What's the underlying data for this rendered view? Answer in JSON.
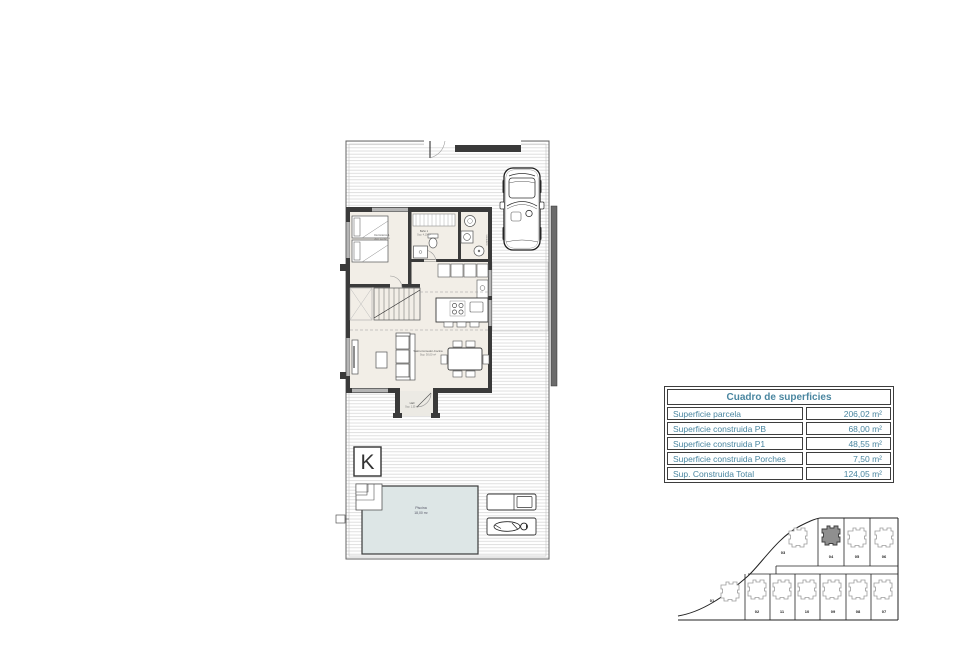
{
  "surfaces_table": {
    "header": "Cuadro de superficies",
    "accent_color": "#4a86a0",
    "rows": [
      {
        "label": "Superficie parcela",
        "value": "206,02 m²"
      },
      {
        "label": "Superficie construida PB",
        "value": "68,00 m²"
      },
      {
        "label": "Superficie construida P1",
        "value": "48,55 m²"
      },
      {
        "label": "Superficie construida Porches",
        "value": "7,50 m²"
      },
      {
        "label": "Sup. Construida Total",
        "value": "124,05 m²"
      }
    ]
  },
  "floor_plan": {
    "logo": "K",
    "rooms": {
      "bedroom": {
        "name": "Dormitorio 1",
        "area": "Sup. 11,90 m²"
      },
      "bathroom": {
        "name": "Baño 1",
        "area": "Sup. 4,10 m²"
      },
      "laundry": {
        "name": "Lavadero",
        "area": ""
      },
      "living": {
        "name": "Salón-Comedor-Cocina",
        "area": "Sup. 30,00 m²"
      },
      "hall": {
        "name": "Hall",
        "area": "Sup. 1,35 m²"
      },
      "pool": {
        "name": "Piscina",
        "area": "18,00 m²"
      }
    }
  },
  "site_plan": {
    "highlighted_plot": "04",
    "plot_labels": [
      "01",
      "02",
      "03",
      "04",
      "05",
      "06",
      "07",
      "08",
      "09",
      "10",
      "11"
    ]
  }
}
